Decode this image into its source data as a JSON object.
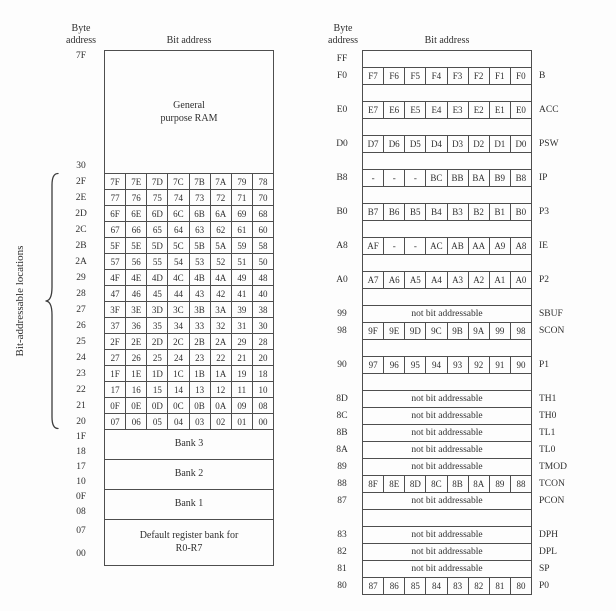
{
  "colors": {
    "ink": "#2f2f2f",
    "border": "#4e4e4e",
    "background": "#fdfdfd"
  },
  "left": {
    "byte_header": "Byte address",
    "bit_header": "Bit address",
    "ram_top_addr": "7F",
    "ram_label": "General purpose RAM",
    "ram_bottom_addr": "30",
    "side_label": "Bit-addressable locations",
    "bit_rows": [
      {
        "addr": "2F",
        "bits": [
          "7F",
          "7E",
          "7D",
          "7C",
          "7B",
          "7A",
          "79",
          "78"
        ]
      },
      {
        "addr": "2E",
        "bits": [
          "77",
          "76",
          "75",
          "74",
          "73",
          "72",
          "71",
          "70"
        ]
      },
      {
        "addr": "2D",
        "bits": [
          "6F",
          "6E",
          "6D",
          "6C",
          "6B",
          "6A",
          "69",
          "68"
        ]
      },
      {
        "addr": "2C",
        "bits": [
          "67",
          "66",
          "65",
          "64",
          "63",
          "62",
          "61",
          "60"
        ]
      },
      {
        "addr": "2B",
        "bits": [
          "5F",
          "5E",
          "5D",
          "5C",
          "5B",
          "5A",
          "59",
          "58"
        ]
      },
      {
        "addr": "2A",
        "bits": [
          "57",
          "56",
          "55",
          "54",
          "53",
          "52",
          "51",
          "50"
        ]
      },
      {
        "addr": "29",
        "bits": [
          "4F",
          "4E",
          "4D",
          "4C",
          "4B",
          "4A",
          "49",
          "48"
        ]
      },
      {
        "addr": "28",
        "bits": [
          "47",
          "46",
          "45",
          "44",
          "43",
          "42",
          "41",
          "40"
        ]
      },
      {
        "addr": "27",
        "bits": [
          "3F",
          "3E",
          "3D",
          "3C",
          "3B",
          "3A",
          "39",
          "38"
        ]
      },
      {
        "addr": "26",
        "bits": [
          "37",
          "36",
          "35",
          "34",
          "33",
          "32",
          "31",
          "30"
        ]
      },
      {
        "addr": "25",
        "bits": [
          "2F",
          "2E",
          "2D",
          "2C",
          "2B",
          "2A",
          "29",
          "28"
        ]
      },
      {
        "addr": "24",
        "bits": [
          "27",
          "26",
          "25",
          "24",
          "23",
          "22",
          "21",
          "20"
        ]
      },
      {
        "addr": "23",
        "bits": [
          "1F",
          "1E",
          "1D",
          "1C",
          "1B",
          "1A",
          "19",
          "18"
        ]
      },
      {
        "addr": "22",
        "bits": [
          "17",
          "16",
          "15",
          "14",
          "13",
          "12",
          "11",
          "10"
        ]
      },
      {
        "addr": "21",
        "bits": [
          "0F",
          "0E",
          "0D",
          "0C",
          "0B",
          "0A",
          "09",
          "08"
        ]
      },
      {
        "addr": "20",
        "bits": [
          "07",
          "06",
          "05",
          "04",
          "03",
          "02",
          "01",
          "00"
        ]
      }
    ],
    "banks": [
      {
        "addr_top": "1F",
        "addr_bottom": "18",
        "label": "Bank 3"
      },
      {
        "addr_top": "17",
        "addr_bottom": "10",
        "label": "Bank 2"
      },
      {
        "addr_top": "0F",
        "addr_bottom": "08",
        "label": "Bank 1"
      },
      {
        "addr_top": "07",
        "addr_bottom": "00",
        "label": "Default register bank for R0-R7"
      }
    ]
  },
  "right": {
    "byte_header": "Byte address",
    "bit_header": "Bit address",
    "na_label": "not bit addressable",
    "rows": [
      {
        "type": "blank",
        "addr": "FF"
      },
      {
        "type": "bits",
        "addr": "F0",
        "bits": [
          "F7",
          "F6",
          "F5",
          "F4",
          "F3",
          "F2",
          "F1",
          "F0"
        ],
        "name": "B"
      },
      {
        "type": "gap"
      },
      {
        "type": "bits",
        "addr": "E0",
        "bits": [
          "E7",
          "E6",
          "E5",
          "E4",
          "E3",
          "E2",
          "E1",
          "E0"
        ],
        "name": "ACC"
      },
      {
        "type": "gap"
      },
      {
        "type": "bits",
        "addr": "D0",
        "bits": [
          "D7",
          "D6",
          "D5",
          "D4",
          "D3",
          "D2",
          "D1",
          "D0"
        ],
        "name": "PSW"
      },
      {
        "type": "gap"
      },
      {
        "type": "bits",
        "addr": "B8",
        "bits": [
          "-",
          "-",
          "-",
          "BC",
          "BB",
          "BA",
          "B9",
          "B8"
        ],
        "name": "IP"
      },
      {
        "type": "gap"
      },
      {
        "type": "bits",
        "addr": "B0",
        "bits": [
          "B7",
          "B6",
          "B5",
          "B4",
          "B3",
          "B2",
          "B1",
          "B0"
        ],
        "name": "P3"
      },
      {
        "type": "gap"
      },
      {
        "type": "bits",
        "addr": "A8",
        "bits": [
          "AF",
          "-",
          "-",
          "AC",
          "AB",
          "AA",
          "A9",
          "A8"
        ],
        "name": "IE"
      },
      {
        "type": "gap"
      },
      {
        "type": "bits",
        "addr": "A0",
        "bits": [
          "A7",
          "A6",
          "A5",
          "A4",
          "A3",
          "A2",
          "A1",
          "A0"
        ],
        "name": "P2"
      },
      {
        "type": "gap"
      },
      {
        "type": "na",
        "addr": "99",
        "name": "SBUF"
      },
      {
        "type": "bits",
        "addr": "98",
        "bits": [
          "9F",
          "9E",
          "9D",
          "9C",
          "9B",
          "9A",
          "99",
          "98"
        ],
        "name": "SCON"
      },
      {
        "type": "gap"
      },
      {
        "type": "bits",
        "addr": "90",
        "bits": [
          "97",
          "96",
          "95",
          "94",
          "93",
          "92",
          "91",
          "90"
        ],
        "name": "P1"
      },
      {
        "type": "gap"
      },
      {
        "type": "na",
        "addr": "8D",
        "name": "TH1"
      },
      {
        "type": "na",
        "addr": "8C",
        "name": "TH0"
      },
      {
        "type": "na",
        "addr": "8B",
        "name": "TL1"
      },
      {
        "type": "na",
        "addr": "8A",
        "name": "TL0"
      },
      {
        "type": "na",
        "addr": "89",
        "name": "TMOD"
      },
      {
        "type": "bits",
        "addr": "88",
        "bits": [
          "8F",
          "8E",
          "8D",
          "8C",
          "8B",
          "8A",
          "89",
          "88"
        ],
        "name": "TCON"
      },
      {
        "type": "na",
        "addr": "87",
        "name": "PCON"
      },
      {
        "type": "gap"
      },
      {
        "type": "na",
        "addr": "83",
        "name": "DPH"
      },
      {
        "type": "na",
        "addr": "82",
        "name": "DPL"
      },
      {
        "type": "na",
        "addr": "81",
        "name": "SP"
      },
      {
        "type": "bits",
        "addr": "80",
        "bits": [
          "87",
          "86",
          "85",
          "84",
          "83",
          "82",
          "81",
          "80"
        ],
        "name": "P0"
      }
    ]
  }
}
